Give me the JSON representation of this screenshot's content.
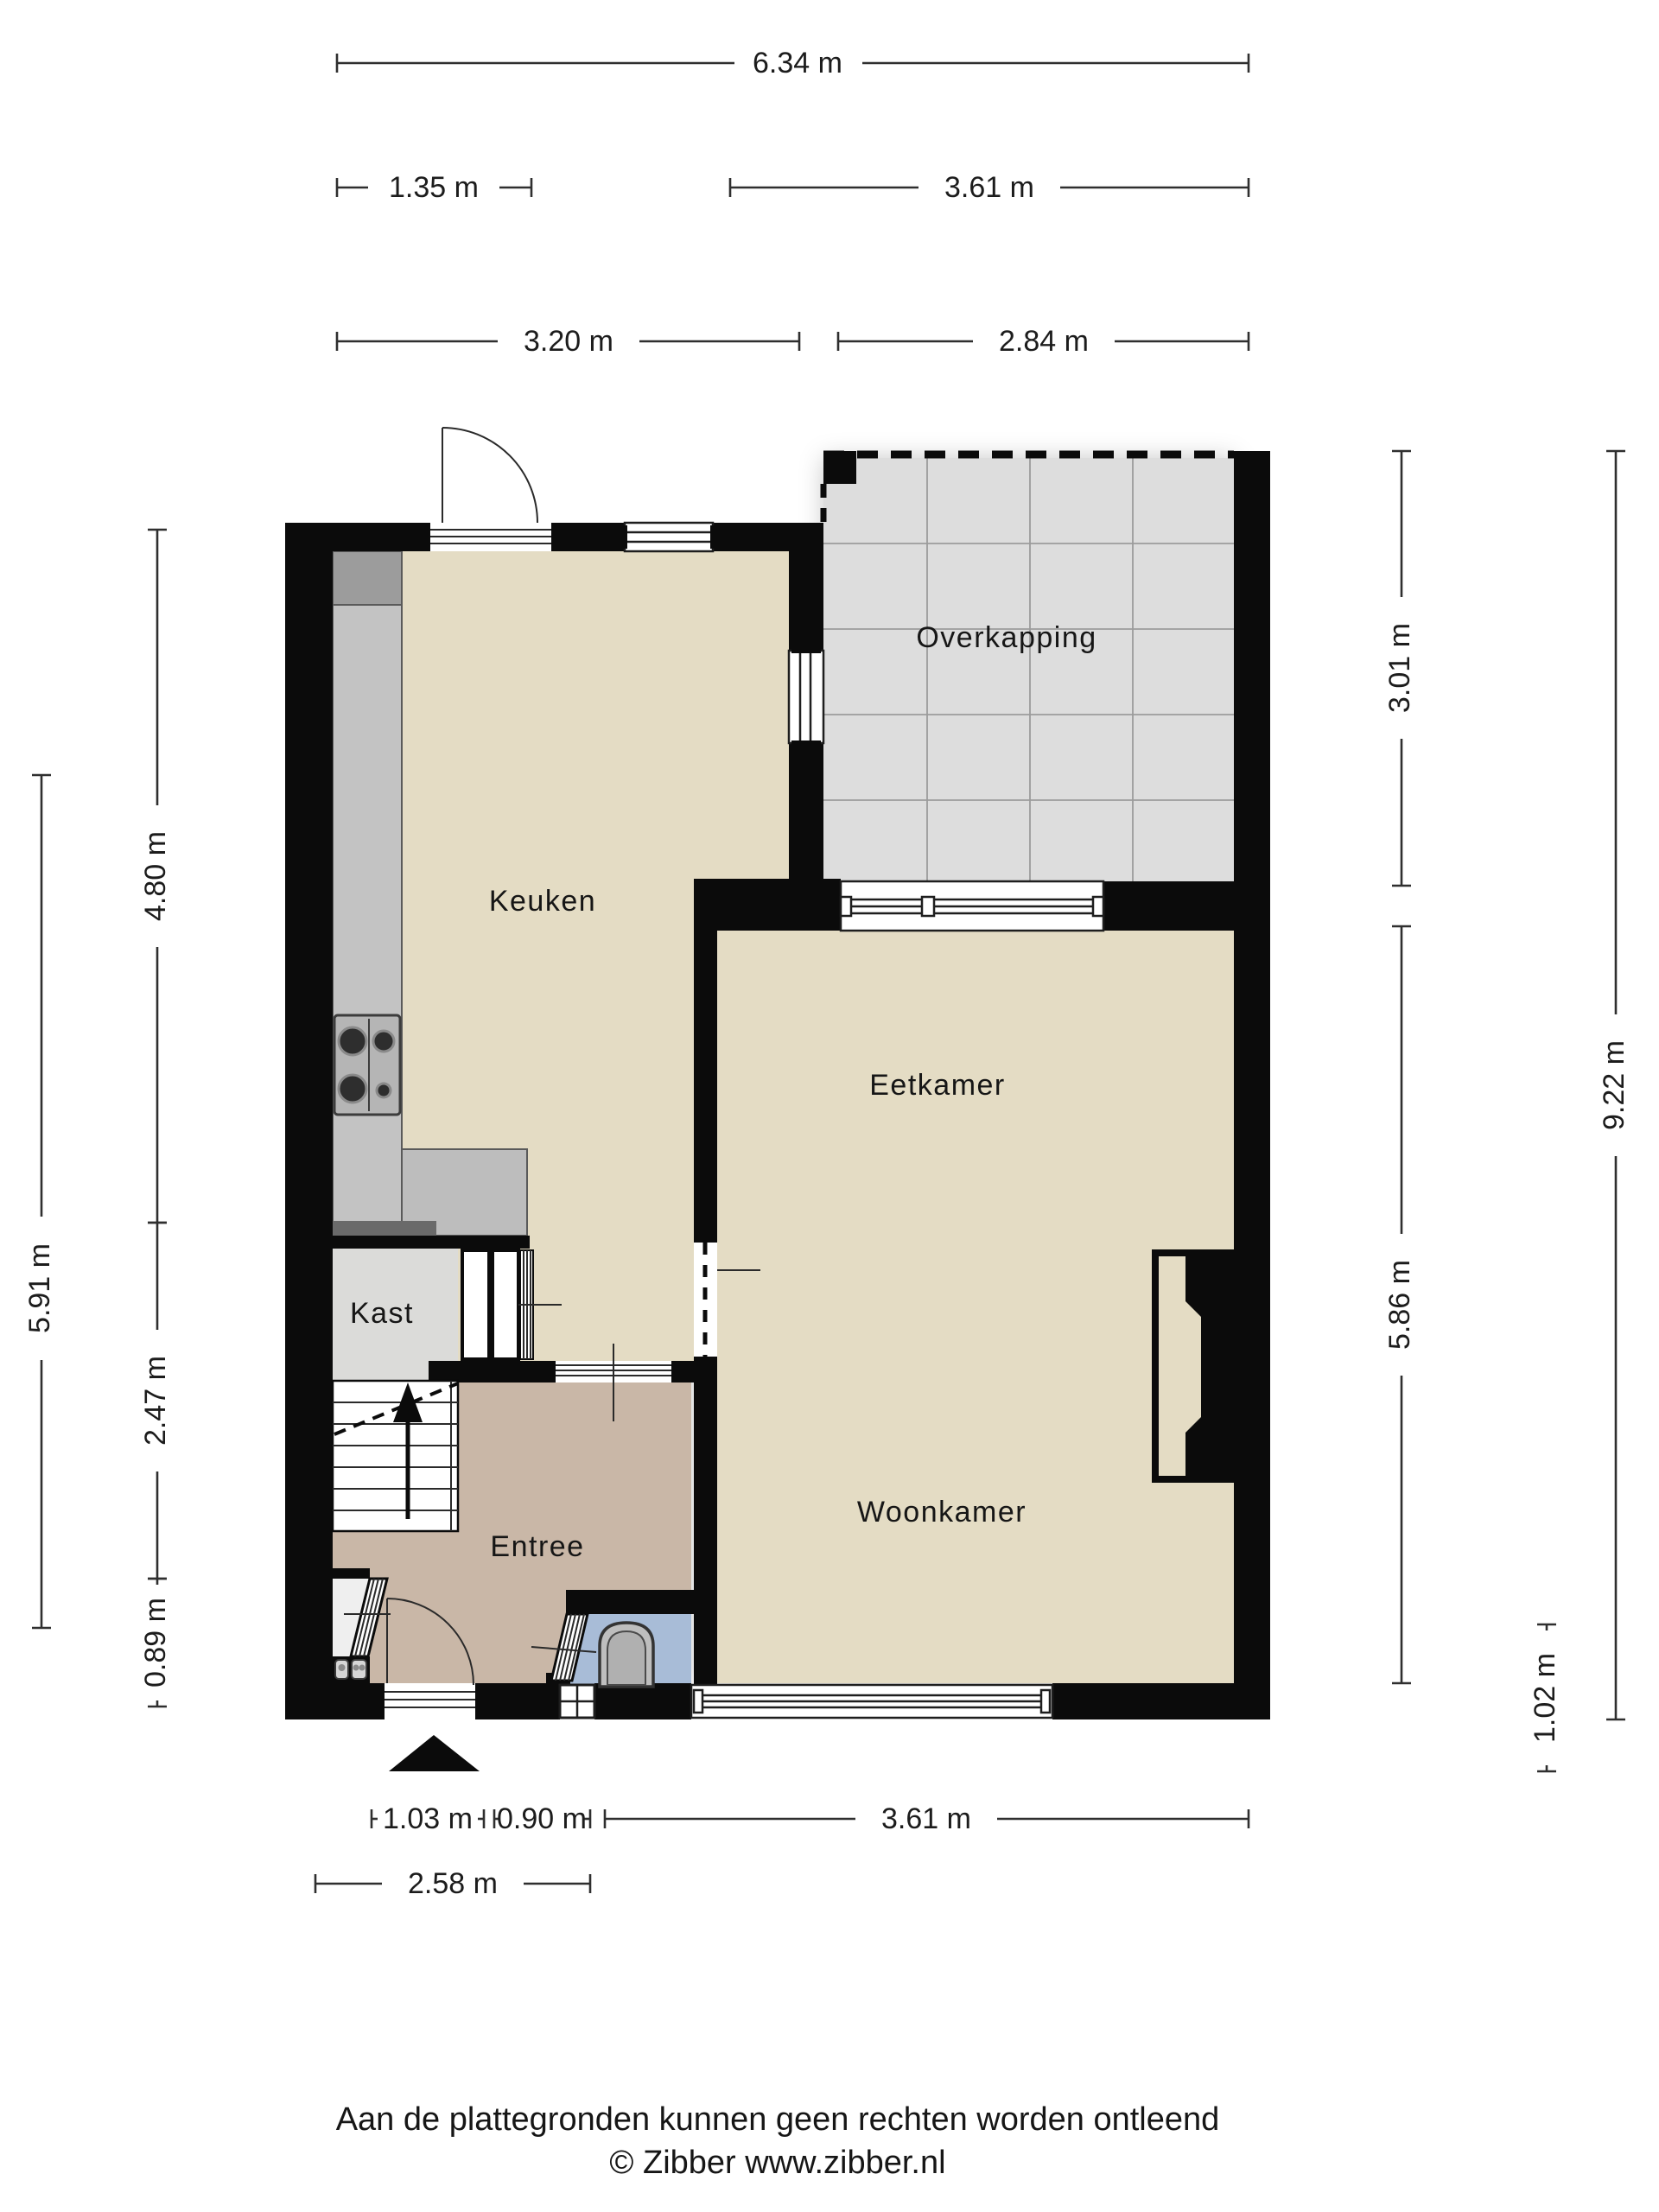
{
  "plan": {
    "rooms": [
      {
        "id": "overkapping",
        "label": "Overkapping"
      },
      {
        "id": "keuken",
        "label": "Keuken"
      },
      {
        "id": "eetkamer",
        "label": "Eetkamer"
      },
      {
        "id": "kast",
        "label": "Kast"
      },
      {
        "id": "entree",
        "label": "Entree"
      },
      {
        "id": "woonkamer",
        "label": "Woonkamer"
      }
    ],
    "dimensions": {
      "top": [
        {
          "label": "6.34 m"
        },
        {
          "label": "1.35 m"
        },
        {
          "label": "3.61 m"
        },
        {
          "label": "3.20 m"
        },
        {
          "label": "2.84 m"
        }
      ],
      "left": [
        {
          "label": "4.80 m"
        },
        {
          "label": "5.91 m"
        },
        {
          "label": "2.47 m"
        },
        {
          "label": "0.89 m"
        }
      ],
      "right": [
        {
          "label": "3.01 m"
        },
        {
          "label": "9.22 m"
        },
        {
          "label": "5.86 m"
        },
        {
          "label": "1.02 m"
        }
      ],
      "bottom": [
        {
          "label": "1.03 m"
        },
        {
          "label": "0.90 m"
        },
        {
          "label": "3.61 m"
        },
        {
          "label": "2.58 m"
        }
      ]
    },
    "colors": {
      "wall": "#0b0b0b",
      "floor_main": "#e4dcc4",
      "floor_entree": "#c9b7a7",
      "floor_toilet": "#a8bcd7",
      "floor_kast": "#dbdbd9",
      "floor_overkapping": "#dddddd",
      "counter": "#c3c3c3",
      "counter_dark": "#9c9c9c"
    }
  },
  "footer": {
    "disclaimer": "Aan de plattegronden kunnen geen rechten worden ontleend",
    "credit": "© Zibber www.zibber.nl"
  }
}
